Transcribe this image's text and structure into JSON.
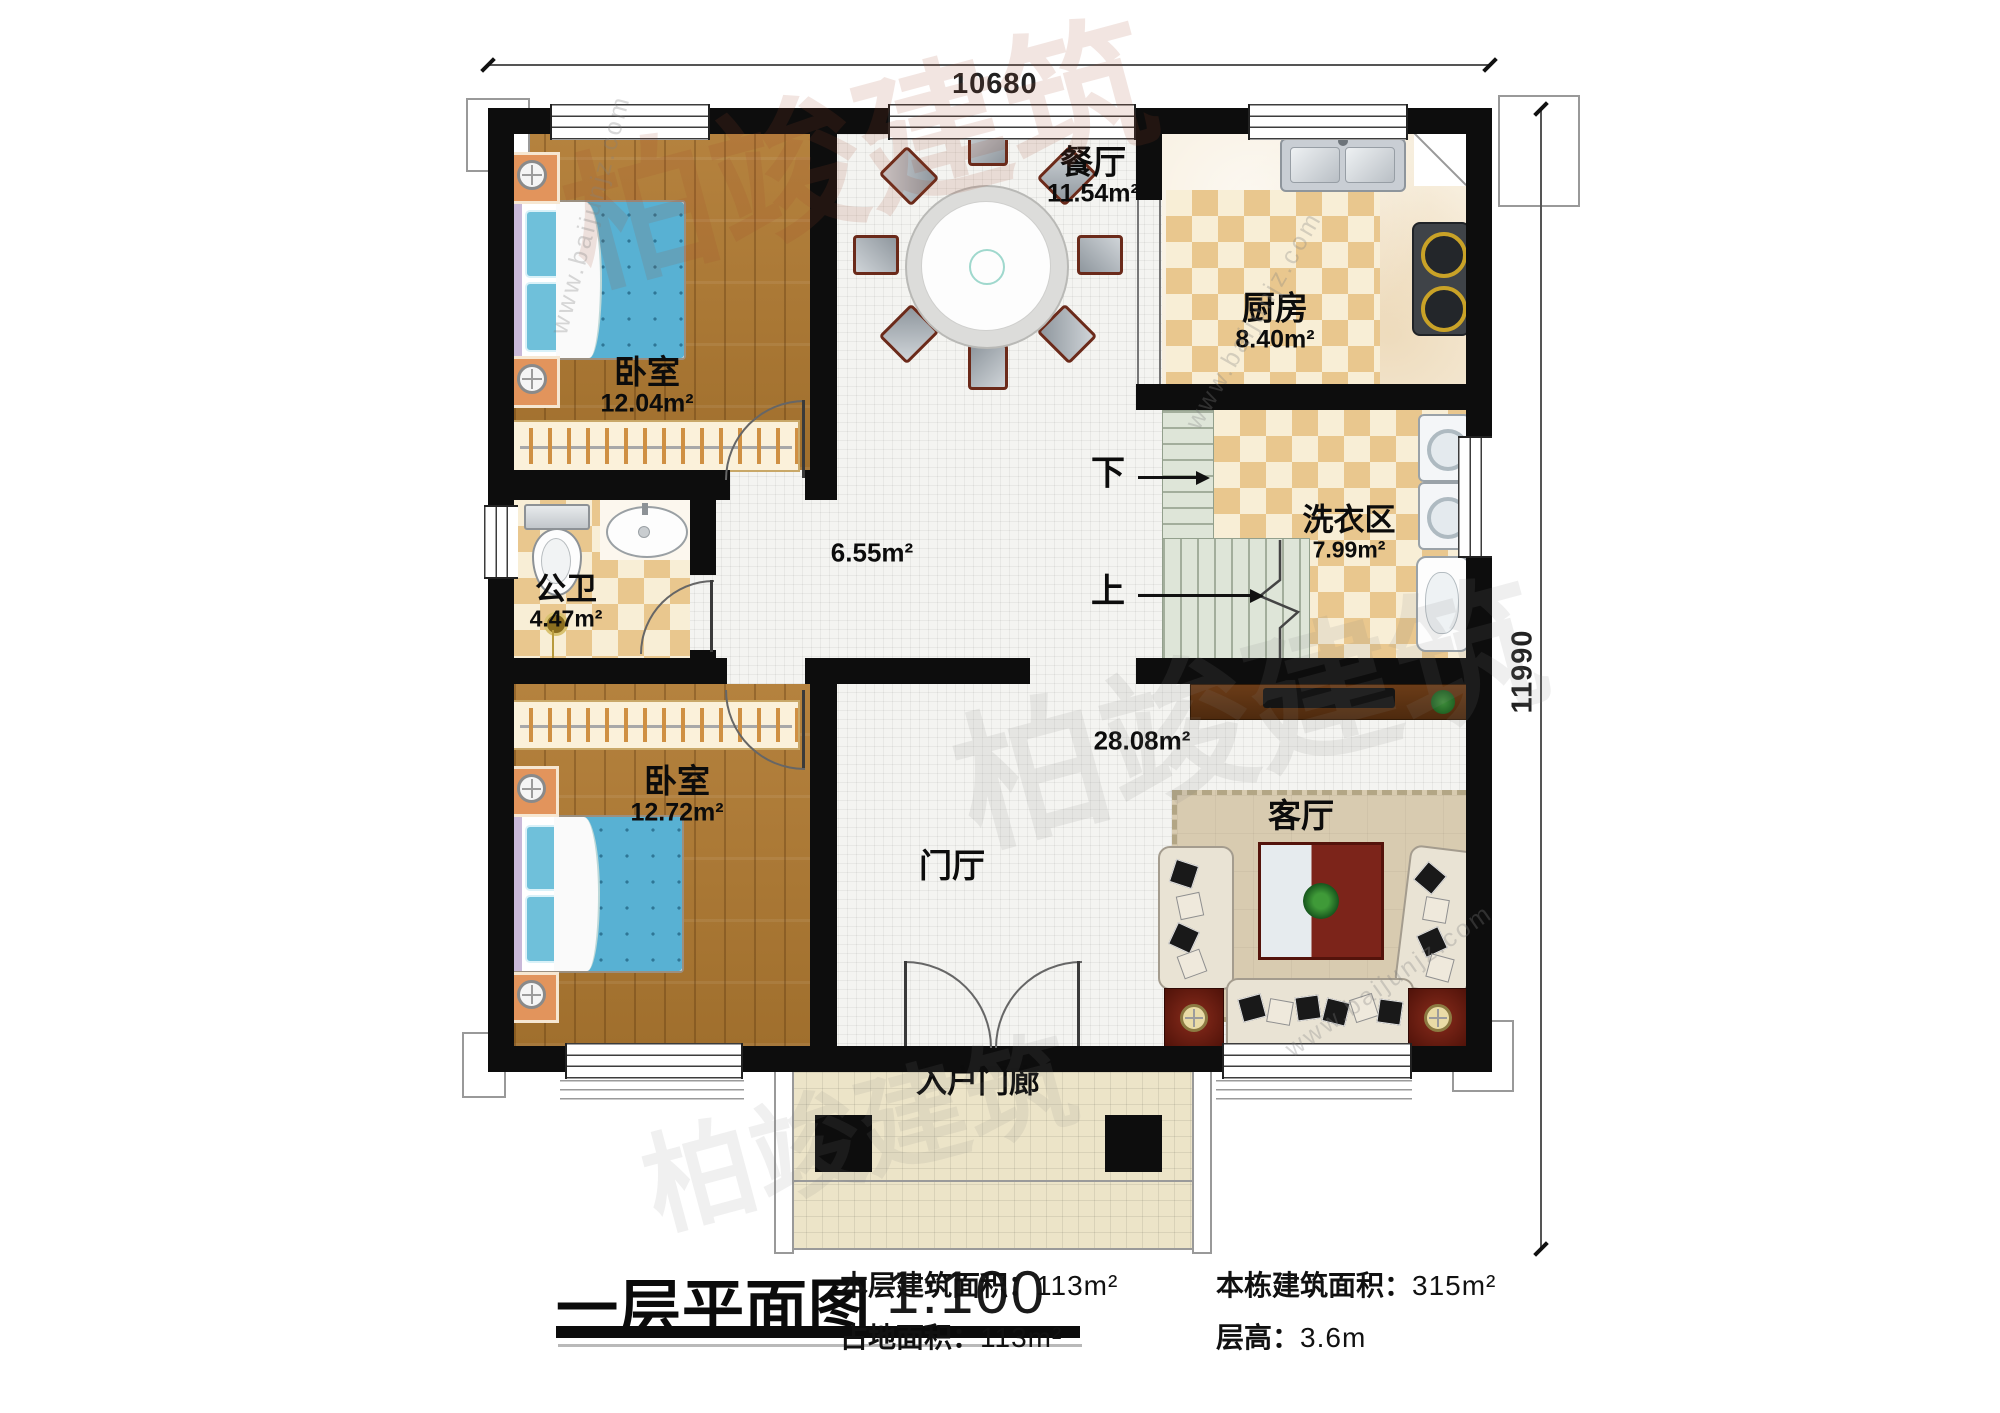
{
  "plan": {
    "dimensions": {
      "width": "10680",
      "height": "11990"
    },
    "rooms": {
      "bedroom_top": {
        "name": "卧室",
        "area": "12.04m²"
      },
      "bedroom_bottom": {
        "name": "卧室",
        "area": "12.72m²"
      },
      "dining": {
        "name": "餐厅",
        "area": "11.54m²"
      },
      "kitchen": {
        "name": "厨房",
        "area": "8.40m²"
      },
      "laundry": {
        "name": "洗衣区",
        "area": "7.99m²"
      },
      "bathroom": {
        "name": "公卫",
        "area": "4.47m²"
      },
      "hall": {
        "area": "6.55m²"
      },
      "living": {
        "name": "客厅",
        "area": "28.08m²"
      },
      "foyer": {
        "name": "门厅"
      },
      "porch": {
        "name": "入户门廊"
      }
    },
    "stairs": {
      "down": "下",
      "up": "上"
    }
  },
  "title_block": {
    "title": "一层平面图",
    "scale": "1:100",
    "floor_area_label": "本层建筑面积：",
    "floor_area_value": "113m²",
    "land_area_label": "占地面积：",
    "land_area_value": "113m²",
    "total_area_label": "本栋建筑面积：",
    "total_area_value": "315m²",
    "height_label": "层高：",
    "height_value": "3.6m"
  },
  "watermark": {
    "url": "www.baijunjz.com",
    "logo": "柏竣建筑"
  },
  "colors": {
    "wall": "#0d0d0d",
    "wood": "#ab7733",
    "tile_tan": "#e9c78e",
    "stair": "#dee5d8",
    "accent_red": "#7c241a"
  }
}
